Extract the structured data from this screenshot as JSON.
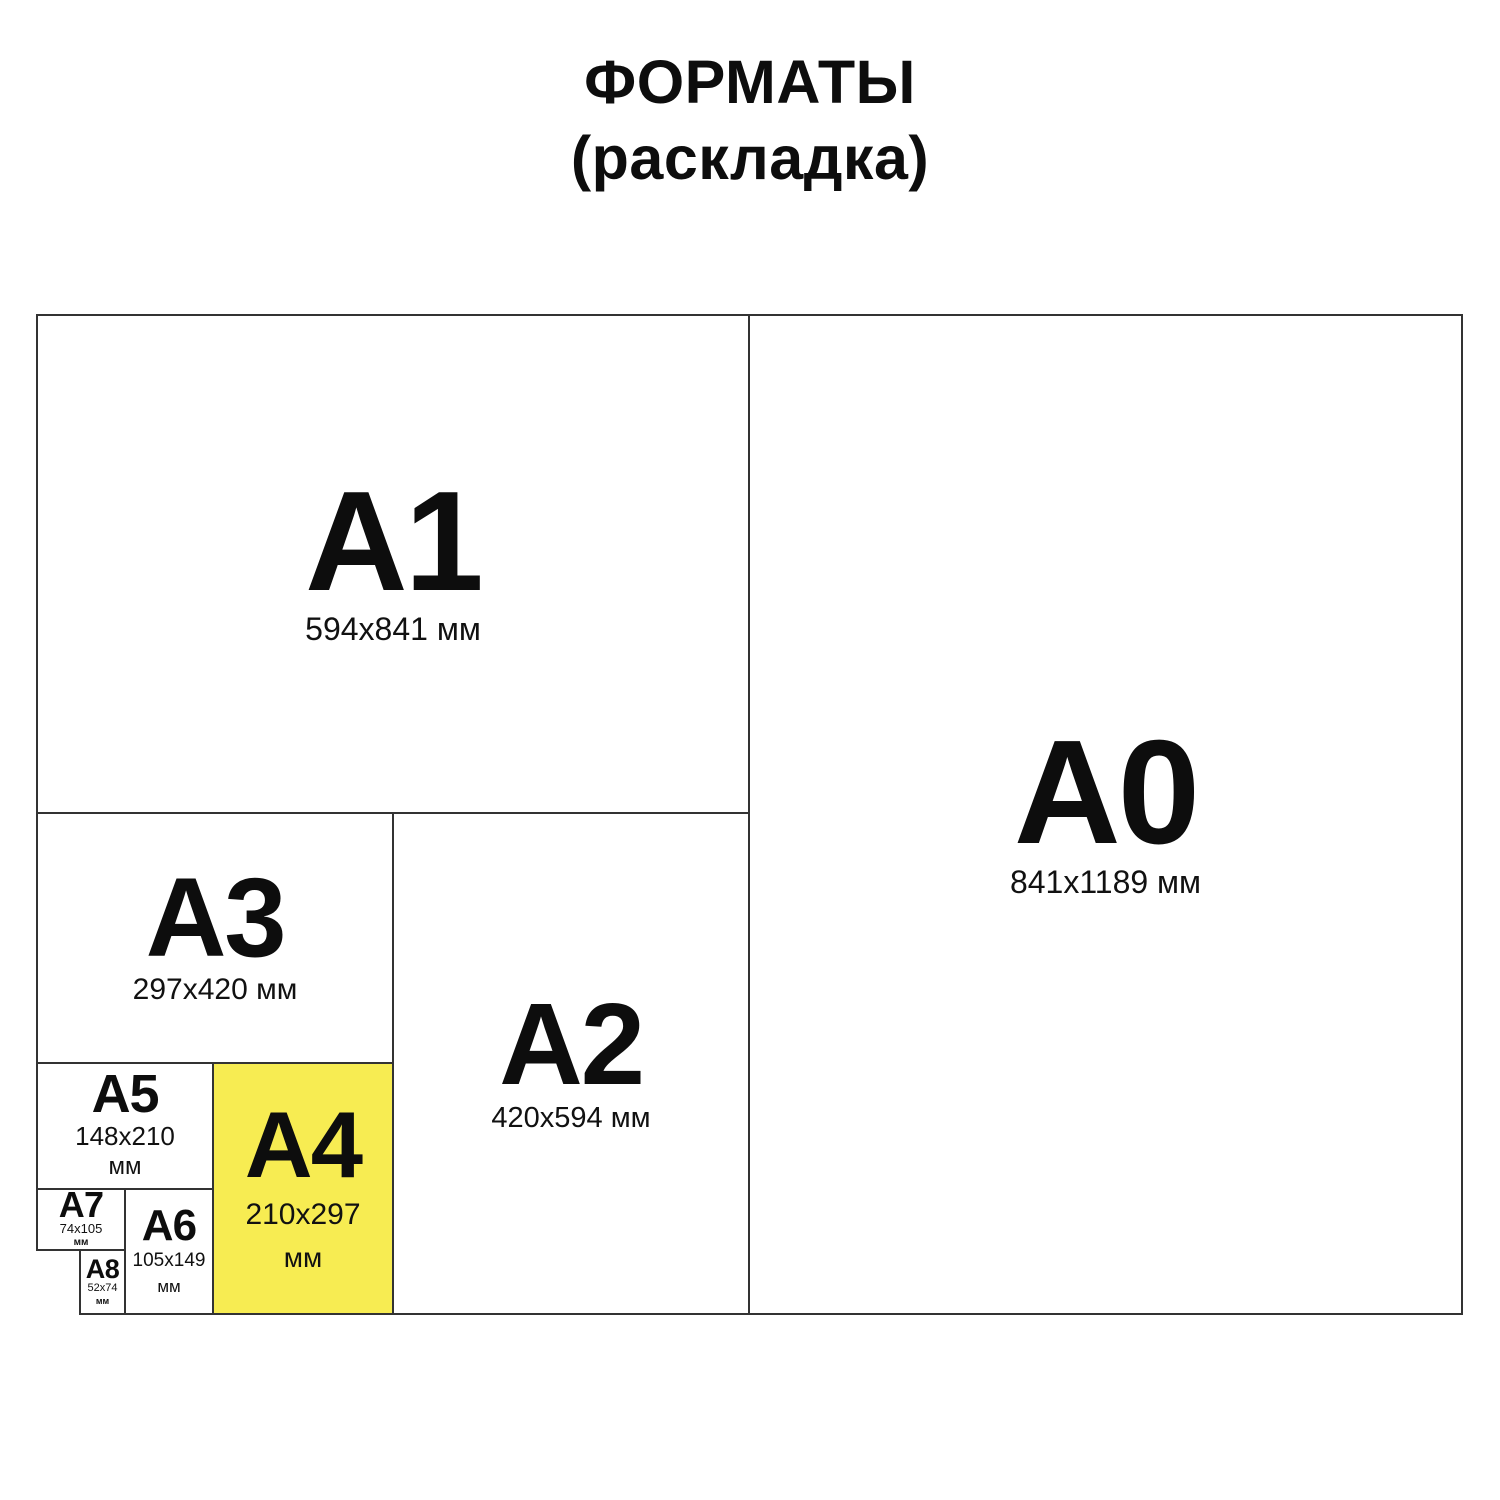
{
  "title": {
    "line1": "ФОРМАТЫ",
    "line2": "(раскладка)"
  },
  "colors": {
    "highlight": "#F7EC52",
    "line": "#333333",
    "text": "#111111",
    "background": "#FFFFFF"
  },
  "formats": [
    {
      "name": "A1",
      "size": "594x841 мм",
      "highlighted": false
    },
    {
      "name": "A0",
      "size": "841x1189 мм",
      "highlighted": false
    },
    {
      "name": "A3",
      "size": "297x420 мм",
      "highlighted": false
    },
    {
      "name": "A2",
      "size": "420x594 мм",
      "highlighted": false
    },
    {
      "name": "A5",
      "size": "148x210",
      "size2": "мм",
      "highlighted": false
    },
    {
      "name": "A4",
      "size": "210x297",
      "size2": "мм",
      "highlighted": true
    },
    {
      "name": "A7",
      "size": "74x105",
      "size2": "мм",
      "highlighted": false
    },
    {
      "name": "A6",
      "size": "105x149",
      "size2": "мм",
      "highlighted": false
    },
    {
      "name": "A8",
      "size": "52x74",
      "size2": "мм",
      "highlighted": false
    }
  ]
}
